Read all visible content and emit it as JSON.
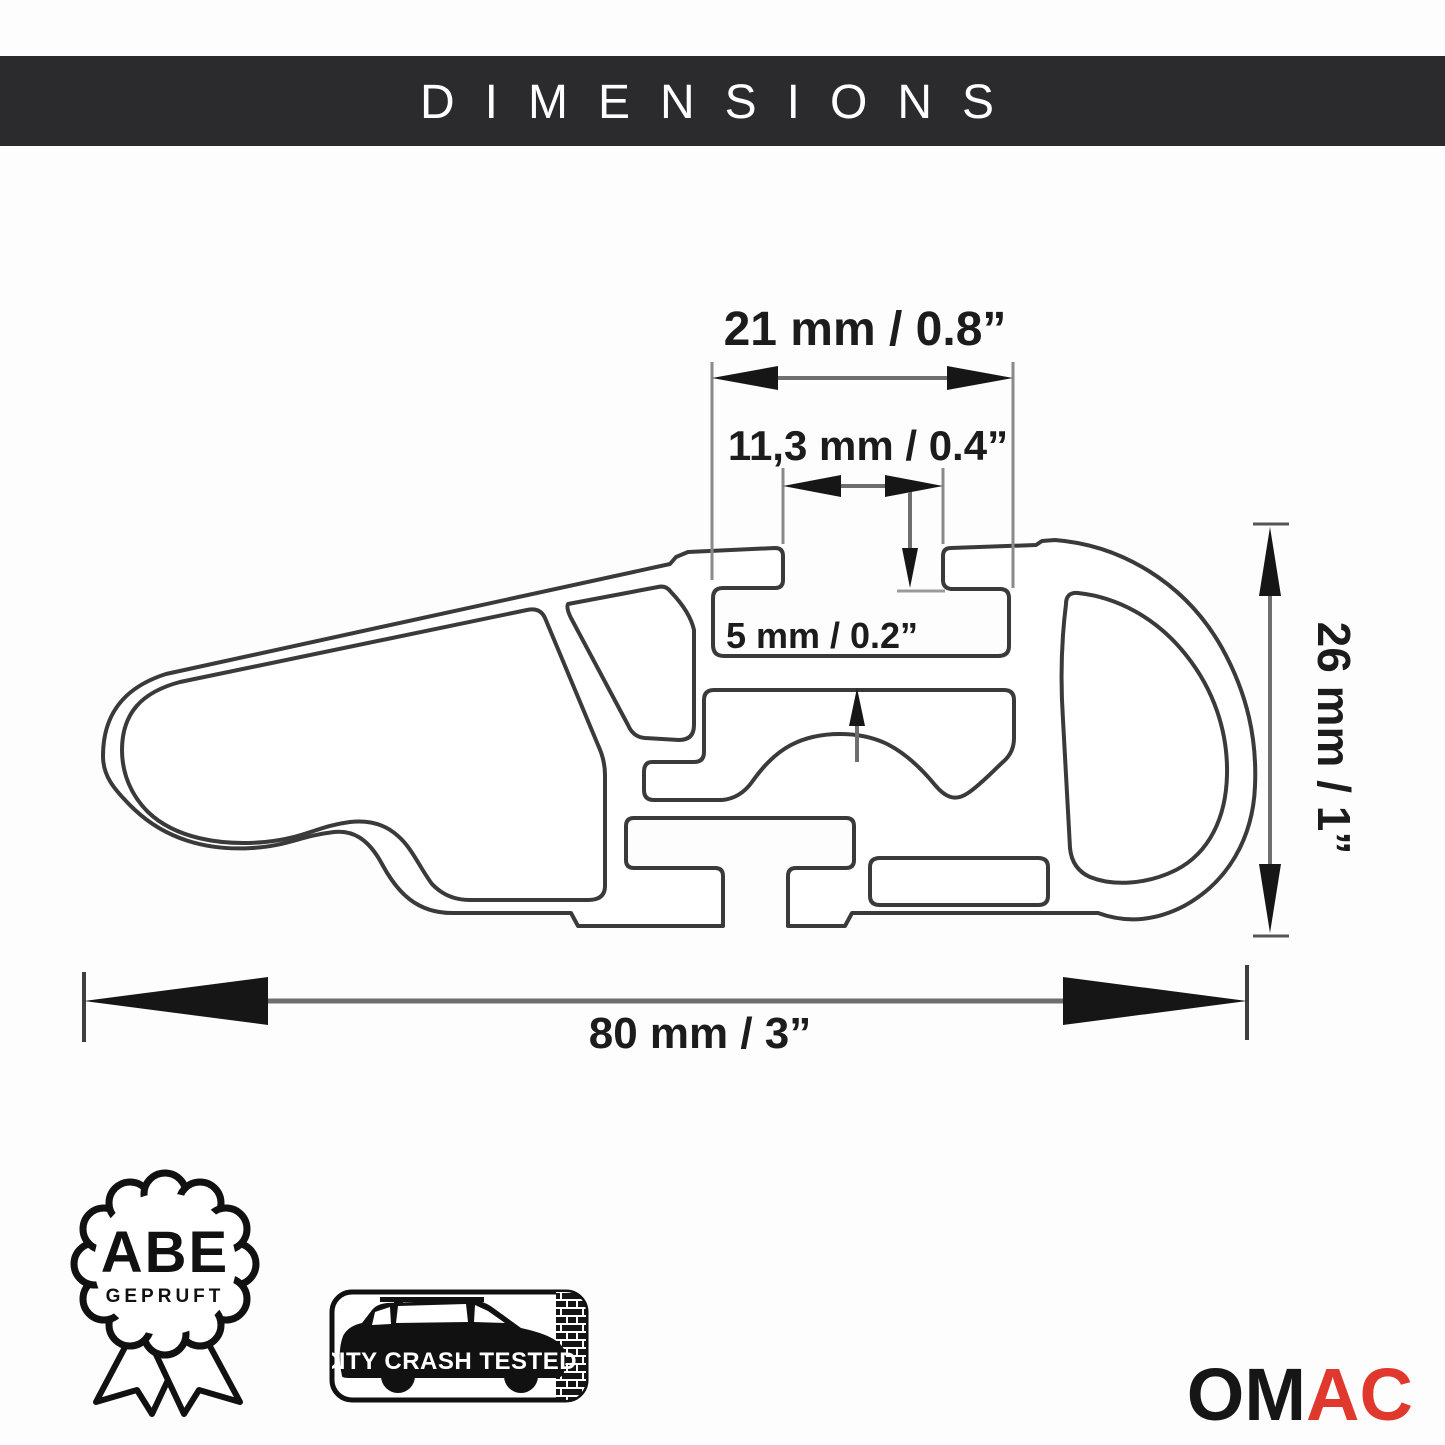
{
  "header": {
    "title": "DIMENSIONS"
  },
  "drawing": {
    "type": "cross-section of aluminum roof-rack crossbar profile",
    "labels": {
      "top_channel_width": "21 mm / 0.8”",
      "slot_opening_width": "11,3 mm / 0.4”",
      "slot_depth": "5 mm / 0.2”",
      "bar_height": "26 mm / 1”",
      "bar_total_width": "80 mm / 3”"
    }
  },
  "badges": {
    "abe": {
      "line1": "ABE",
      "line2": "GEPRUFT"
    },
    "crash": {
      "label": "CITY CRASH TESTED"
    },
    "brand": {
      "black_part": "OM",
      "red_part": "AC"
    }
  },
  "colors": {
    "header_bg": "#2b2b2d",
    "header_fg": "#ffffff",
    "profile_line": "#3a3a3a",
    "dimension_line": "#7a7a7a",
    "arrowhead": "#161616",
    "badge_ink": "#111111",
    "brand_black": "#161616",
    "brand_red": "#e0382c"
  }
}
